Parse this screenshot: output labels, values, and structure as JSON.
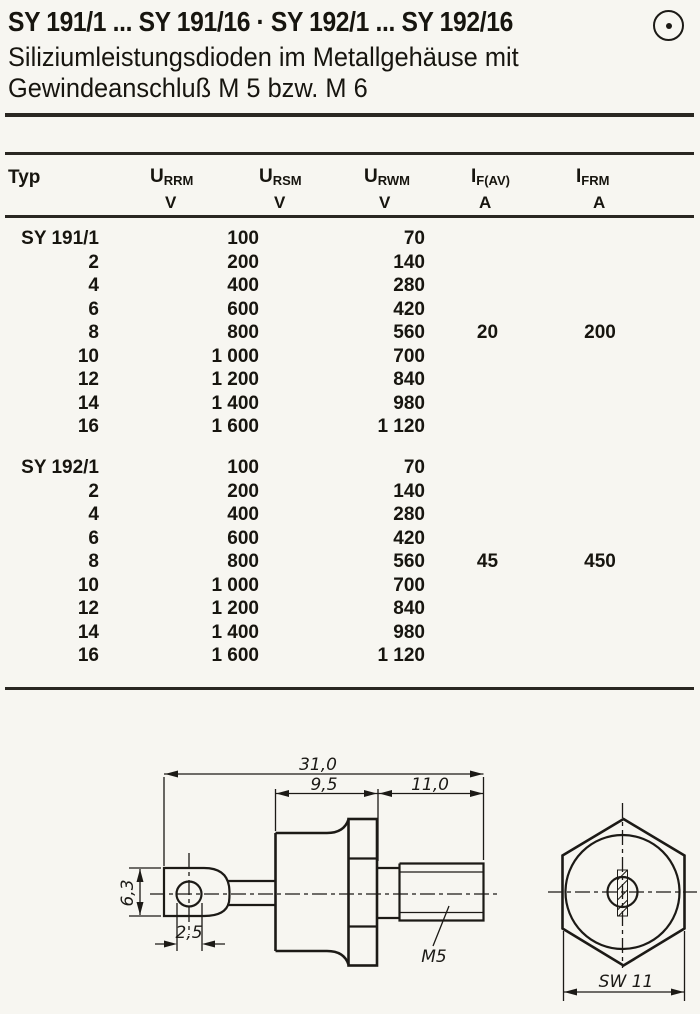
{
  "header": {
    "title": "SY 191/1 ... SY 191/16 · SY 192/1 ... SY 192/16",
    "subtitle_line1": "Siliziumleistungsdioden im Metallgehäuse mit",
    "subtitle_line2": "Gewindeanschluß M 5 bzw. M 6",
    "mark_icon": "circled-dot"
  },
  "table": {
    "columns": [
      {
        "label": "Typ",
        "unit": ""
      },
      {
        "sym": "U",
        "sub": "RRM",
        "unit": "V"
      },
      {
        "sym": "U",
        "sub": "RSM",
        "unit": "V"
      },
      {
        "sym": "U",
        "sub": "RWM",
        "unit": "V"
      },
      {
        "sym": "I",
        "sub": "F(AV)",
        "unit": "A"
      },
      {
        "sym": "I",
        "sub": "FRM",
        "unit": "A"
      }
    ],
    "blocks": [
      {
        "series": "SY 191",
        "if_av": "20",
        "ifrm": "200",
        "rows": [
          {
            "typ": "SY 191/1",
            "urrm": "100",
            "urwm": "70"
          },
          {
            "typ": "2",
            "urrm": "200",
            "urwm": "140"
          },
          {
            "typ": "4",
            "urrm": "400",
            "urwm": "280"
          },
          {
            "typ": "6",
            "urrm": "600",
            "urwm": "420"
          },
          {
            "typ": "8",
            "urrm": "800",
            "urwm": "560"
          },
          {
            "typ": "10",
            "urrm": "1 000",
            "urwm": "700"
          },
          {
            "typ": "12",
            "urrm": "1 200",
            "urwm": "840"
          },
          {
            "typ": "14",
            "urrm": "1 400",
            "urwm": "980"
          },
          {
            "typ": "16",
            "urrm": "1 600",
            "urwm": "1 120"
          }
        ]
      },
      {
        "series": "SY 192",
        "if_av": "45",
        "ifrm": "450",
        "rows": [
          {
            "typ": "SY 192/1",
            "urrm": "100",
            "urwm": "70"
          },
          {
            "typ": "2",
            "urrm": "200",
            "urwm": "140"
          },
          {
            "typ": "4",
            "urrm": "400",
            "urwm": "280"
          },
          {
            "typ": "6",
            "urrm": "600",
            "urwm": "420"
          },
          {
            "typ": "8",
            "urrm": "800",
            "urwm": "560"
          },
          {
            "typ": "10",
            "urrm": "1 000",
            "urwm": "700"
          },
          {
            "typ": "12",
            "urrm": "1 200",
            "urwm": "840"
          },
          {
            "typ": "14",
            "urrm": "1 400",
            "urwm": "980"
          },
          {
            "typ": "16",
            "urrm": "1 600",
            "urwm": "1 120"
          }
        ]
      }
    ]
  },
  "drawing": {
    "dim_total": "31,0",
    "dim_body": "9,5",
    "dim_stud": "11,0",
    "dim_lug_height": "6,3",
    "dim_hole": "2,5",
    "thread_label": "M5",
    "wrench_size": "SW 11"
  }
}
